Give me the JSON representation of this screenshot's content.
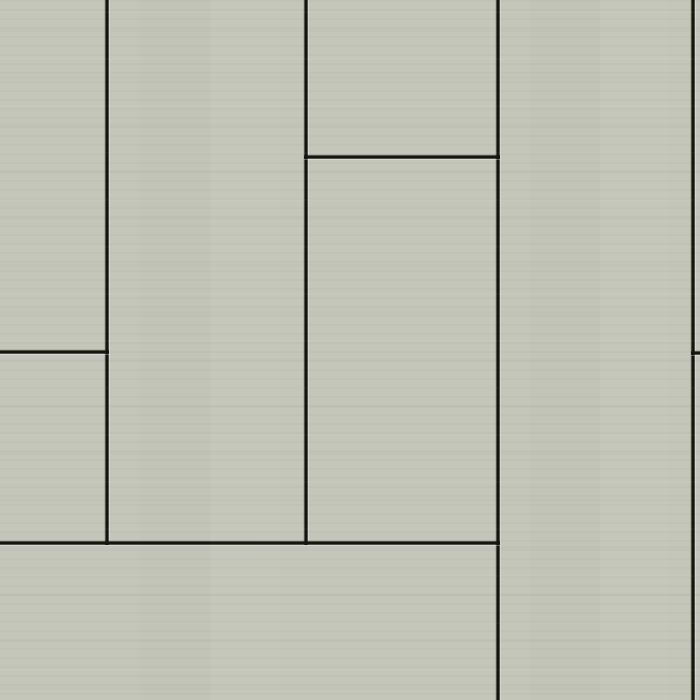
{
  "canvas": {
    "width": 700,
    "height": 700
  },
  "palette": {
    "panel": "#c5c6ba",
    "panel_highlight": "#d3d4c8",
    "panel_shadow": "#b9bab0",
    "joint": "#14150f"
  },
  "pattern": {
    "type": "staggered-vertical-panels",
    "joint_thickness": 4,
    "vertical_joints": [
      {
        "name": "v1",
        "x": 105,
        "from_y": 0,
        "to_y": 545
      },
      {
        "name": "v2",
        "x": 304,
        "from_y": 0,
        "to_y": 545
      },
      {
        "name": "v3",
        "x": 496,
        "from_y": 0,
        "to_y": 700
      },
      {
        "name": "v4",
        "x": 691,
        "from_y": 0,
        "to_y": 700
      }
    ],
    "horizontal_joints": [
      {
        "name": "h1",
        "y": 155,
        "from_x": 304,
        "to_x": 500
      },
      {
        "name": "h2",
        "y": 350,
        "from_x": 0,
        "to_x": 109
      },
      {
        "name": "h3",
        "y": 541,
        "from_x": 0,
        "to_x": 500
      },
      {
        "name": "h4",
        "y": 351,
        "from_x": 691,
        "to_x": 700
      }
    ]
  }
}
